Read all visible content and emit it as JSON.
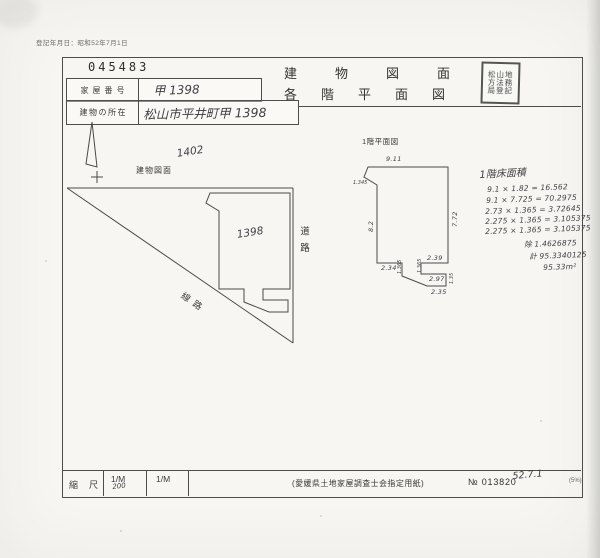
{
  "page": {
    "reg_date_note": "登記年月日：昭和52年7月1日",
    "serial_number": "045483",
    "title_line1": "建物図面",
    "title_line2": "各階平面図",
    "stamp_rows": [
      "松山地",
      "方法務",
      "局登記"
    ]
  },
  "info_table": {
    "house_number_label": "家屋番号",
    "house_number_value": "甲 1398",
    "location_label": "建物の所在",
    "location_value": "松山市平井町甲 1398"
  },
  "site_plan": {
    "label": "建物図面",
    "north_lot_number": "1402",
    "building_lot_number": "1398",
    "road_label": "道路",
    "railway_label": "線路"
  },
  "floor_plan": {
    "label": "1階平面図",
    "dim_top": "9.11",
    "dim_notch": "1.345",
    "dim_left": "8.2",
    "dim_right": "7.72",
    "dim_bottom_left": "2.34",
    "dim_drop_left": "1.365",
    "dim_bottom_right_upper": "2.39",
    "dim_drop_right": "1.365",
    "dim_bottom_right_mid": "2.97",
    "dim_bottom_right_lower": "2.35",
    "dim_side_small": "1.35"
  },
  "area_calc": {
    "title": "1階床面積",
    "lines": [
      "9.1 × 1.82 = 16.562",
      "9.1 × 7.725 = 70.2975",
      "2.73 × 1.365 = 3.72645",
      "2.275 × 1.365 = 3.105375",
      "2.275 × 1.365 = 3.105375"
    ],
    "deduction": "除 1.4626875",
    "total": "計 95.3340125",
    "result": "95.33m²"
  },
  "footer": {
    "scale_label": "縮尺",
    "scale1_printed": "1/M",
    "scale1_value": "200",
    "scale2_printed": "1/M",
    "paper_note": "(愛媛県土地家屋調査士会指定用紙)",
    "form_number": "№ 013820",
    "date_note": "52.7.1",
    "corner_note": "(5%)"
  }
}
